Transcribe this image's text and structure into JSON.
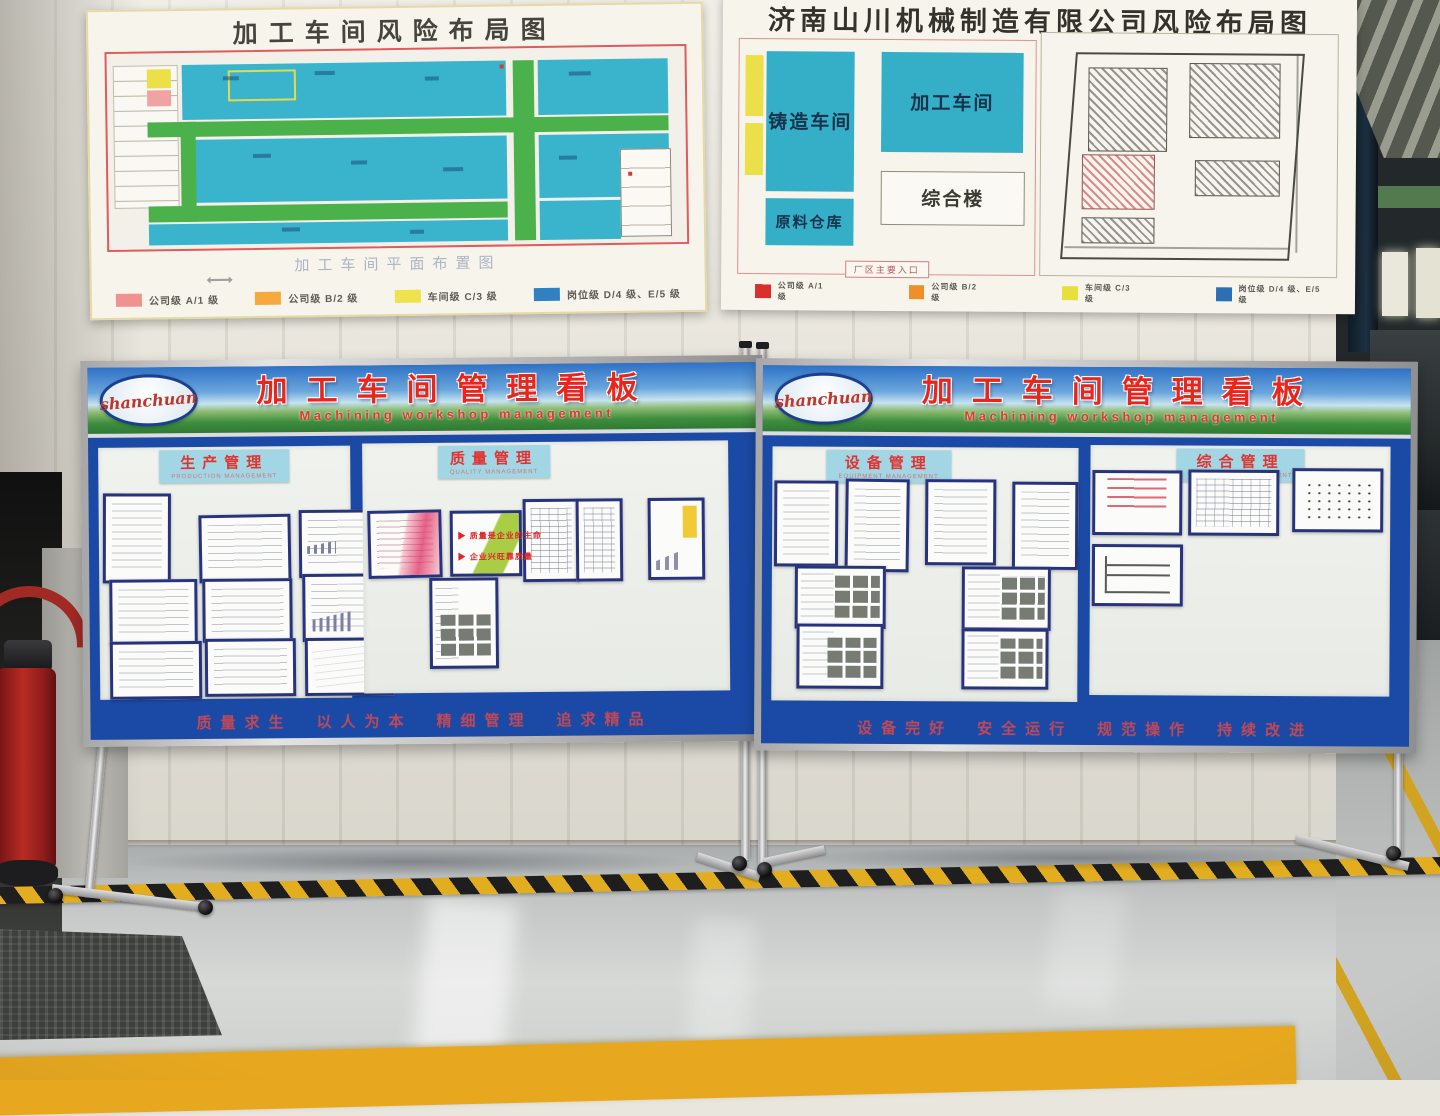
{
  "posters": {
    "left": {
      "title": "加工车间风险布局图",
      "caption": "加工车间平面布置图",
      "legend": [
        {
          "label": "公司级 A/1 级",
          "color": "#f09390"
        },
        {
          "label": "公司级 B/2 级",
          "color": "#f6aa3e"
        },
        {
          "label": "车间级 C/3 级",
          "color": "#eee24e"
        },
        {
          "label": "岗位级 D/4 级、E/5 级",
          "color": "#3181c1"
        }
      ]
    },
    "right": {
      "title": "济南山川机械制造有限公司风险布局图",
      "blocks": {
        "casting": "铸造车间",
        "machining": "加工车间",
        "office": "综合楼",
        "warehouse": "原料仓库",
        "entrance": "厂区主要入口"
      },
      "legend": [
        {
          "label": "公司级 A/1 级",
          "color": "#d8302c"
        },
        {
          "label": "公司级 B/2 级",
          "color": "#ef8f2a"
        },
        {
          "label": "车间级 C/3 级",
          "color": "#e7e03c"
        },
        {
          "label": "岗位级 D/4 级、E/5 级",
          "color": "#2e6fb4"
        }
      ]
    }
  },
  "kanban": {
    "logo_text": "shanchuan",
    "title": "加工车间管理看板",
    "subtitle": "Machining workshop management",
    "left_board": {
      "sections": [
        {
          "cn": "生产管理",
          "en": "PRODUCTION MANAGEMENT"
        },
        {
          "cn": "质量管理",
          "en": "QUALITY MANAGEMENT"
        }
      ],
      "quality_lines": [
        "▶ 质量是企业的生命",
        "▶ 企业兴旺靠质量"
      ],
      "slogan": "质量求生　以人为本　精细管理　追求精品"
    },
    "right_board": {
      "sections": [
        {
          "cn": "设备管理",
          "en": "EQUIPMENT MANAGEMENT"
        },
        {
          "cn": "综合管理",
          "en": "INTEGRATED MANAGEMENT"
        }
      ],
      "slogan": "设备完好　安全运行　规范操作　持续改进"
    }
  }
}
